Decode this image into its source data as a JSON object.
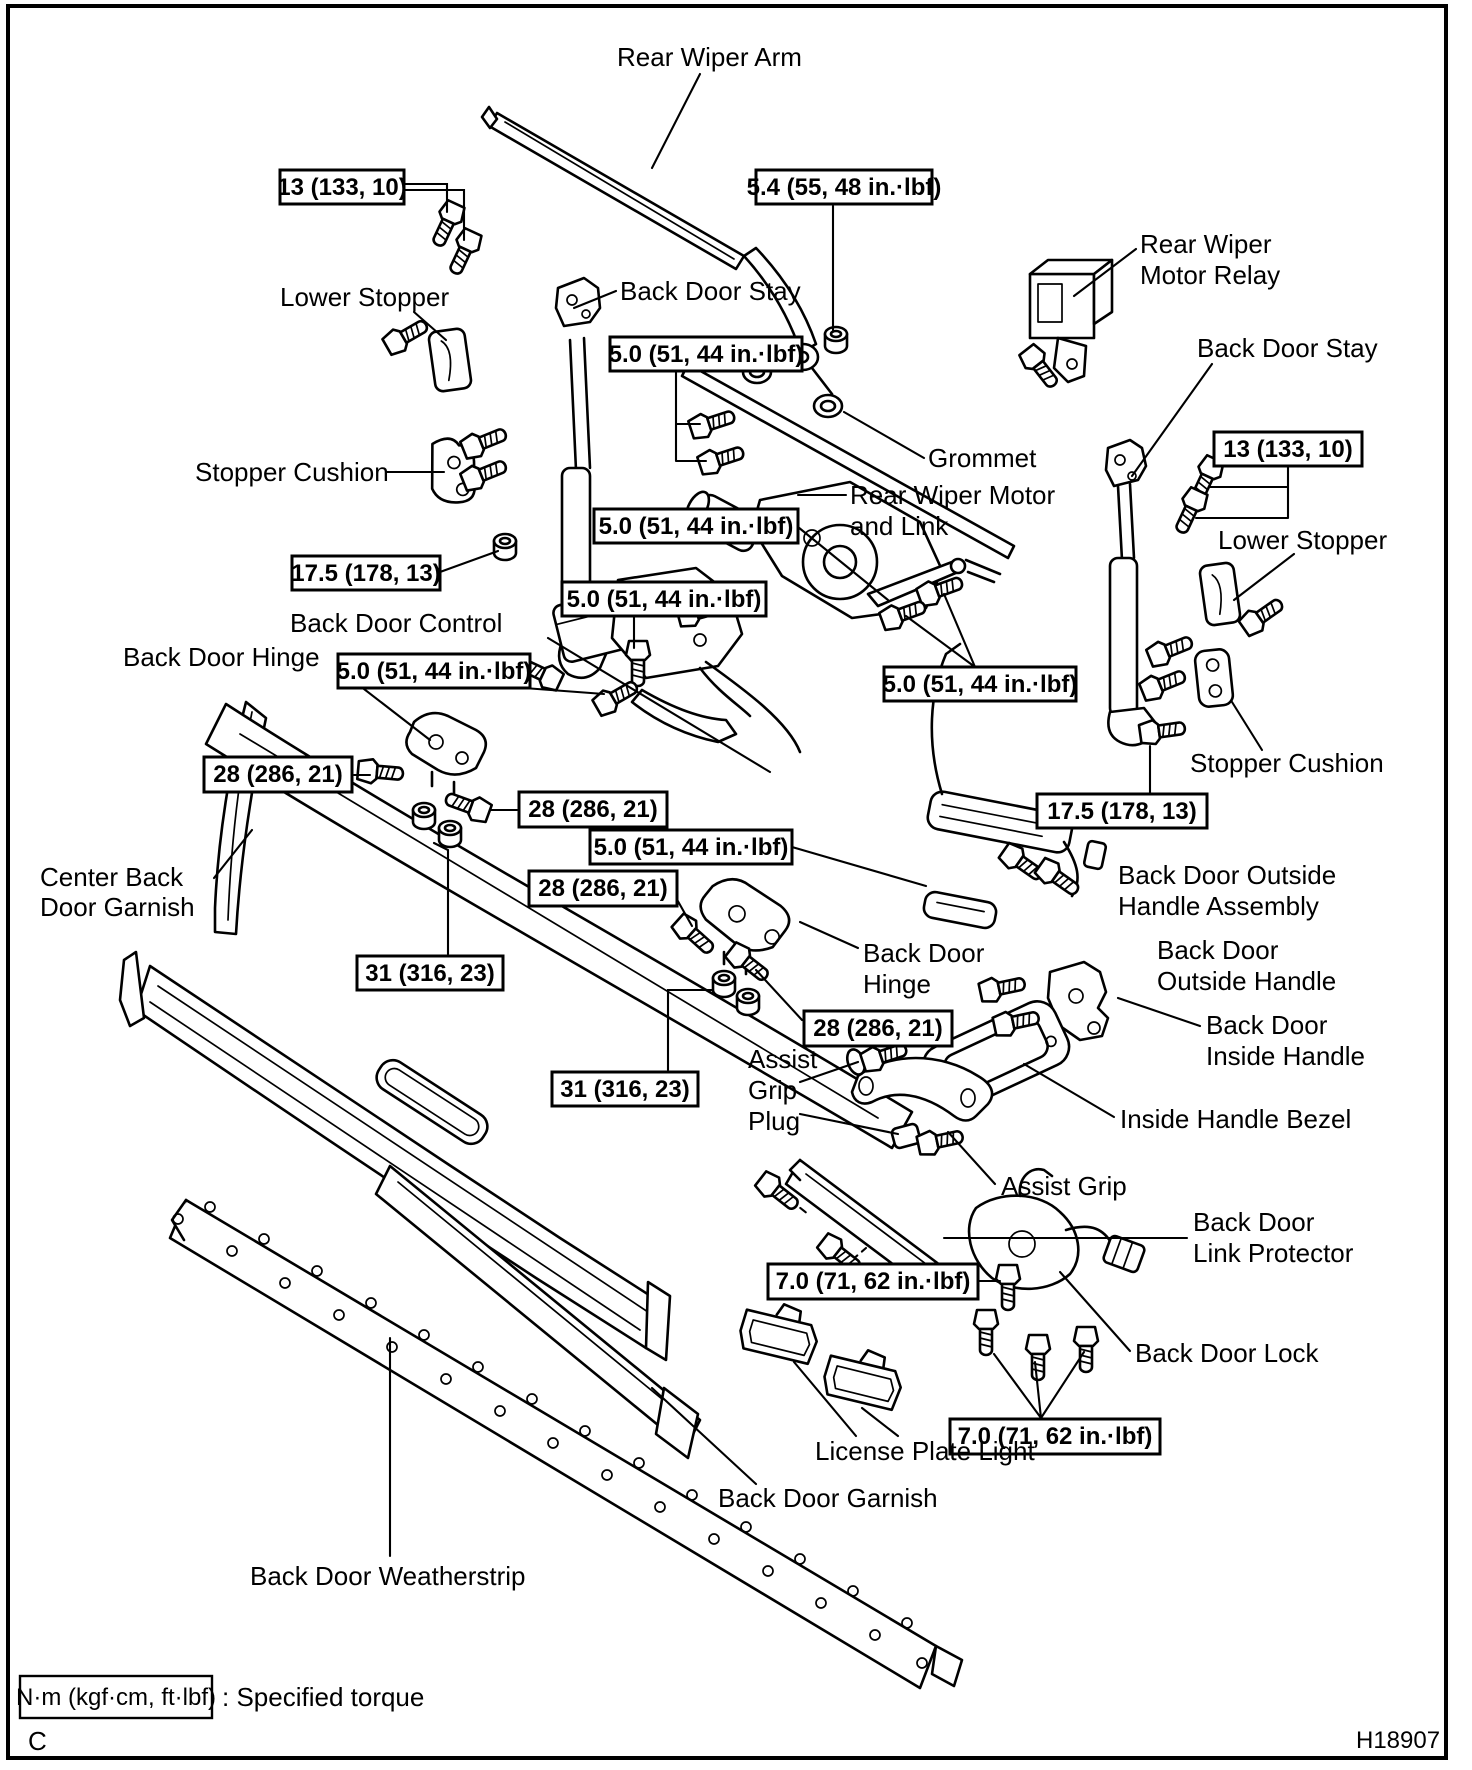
{
  "colors": {
    "ink": "#000000",
    "paper": "#ffffff"
  },
  "figure": {
    "torque_values": {
      "t13": "13 (133, 10)",
      "t54": "5.4 (55, 48 in.·lbf)",
      "t50": "5.0 (51, 44 in.·lbf)",
      "t175": "17.5 (178, 13)",
      "t28": "28 (286, 21)",
      "t31": "31 (316, 23)",
      "t70": "7.0 (71, 62 in.·lbf)"
    },
    "labels": {
      "rear_wiper_arm": "Rear Wiper Arm",
      "lower_stopper_left": "Lower Stopper",
      "back_door_stay_left": "Back Door Stay",
      "rear_wiper_motor_relay_1": "Rear Wiper",
      "rear_wiper_motor_relay_2": "Motor Relay",
      "back_door_stay_right": "Back Door Stay",
      "grommet": "Grommet",
      "rear_wiper_motor_link_1": "Rear Wiper Motor",
      "rear_wiper_motor_link_2": "and Link",
      "stopper_cushion_left": "Stopper Cushion",
      "back_door_control": "Back Door Control",
      "back_door_hinge_left": "Back Door Hinge",
      "lower_stopper_right": "Lower Stopper",
      "stopper_cushion_right": "Stopper Cushion",
      "outside_handle_assembly_1": "Back Door Outside",
      "outside_handle_assembly_2": "Handle Assembly",
      "outside_handle_1": "Back Door",
      "outside_handle_2": "Outside Handle",
      "center_back_door_garnish_1": "Center Back",
      "center_back_door_garnish_2": "Door Garnish",
      "back_door_hinge_center_1": "Back Door",
      "back_door_hinge_center_2": "Hinge",
      "inside_handle_1": "Back Door",
      "inside_handle_2": "Inside Handle",
      "inside_handle_bezel": "Inside Handle Bezel",
      "assist_grip_plug_1": "Assist",
      "assist_grip_plug_2": "Grip",
      "assist_grip_plug_3": "Plug",
      "assist_grip": "Assist Grip",
      "link_protector_1": "Back Door",
      "link_protector_2": "Link Protector",
      "back_door_lock": "Back Door Lock",
      "license_plate_light": "License Plate Light",
      "back_door_garnish": "Back Door Garnish",
      "back_door_weatherstrip": "Back Door Weatherstrip"
    },
    "legend": {
      "unit_box": "N·m (kgf·cm, ft·lbf)",
      "meaning": ": Specified torque"
    },
    "footer": {
      "page_marker": "C",
      "figure_code": "H18907"
    }
  }
}
